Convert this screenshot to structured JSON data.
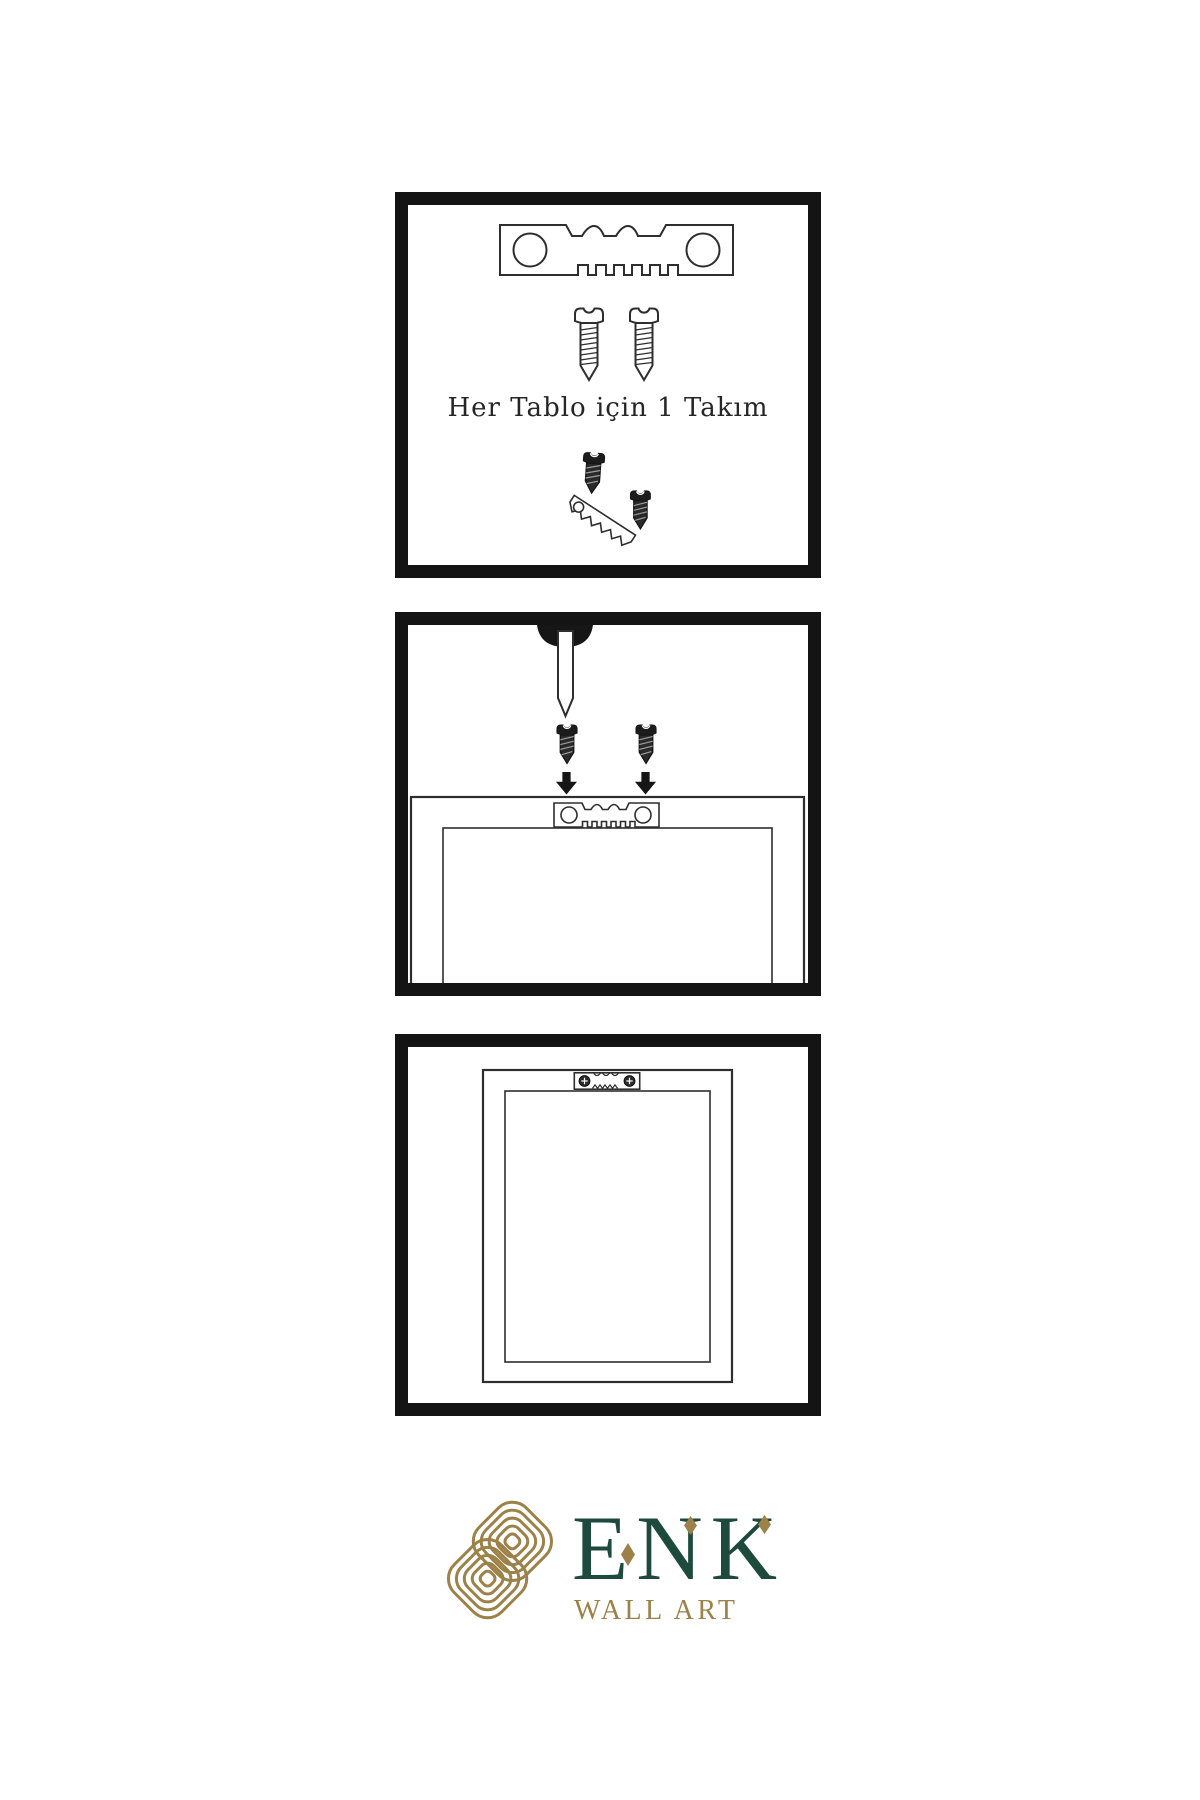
{
  "panels": [
    {
      "name": "hardware-kit-step",
      "caption": "Her Tablo için 1 Takım",
      "icons": [
        "sawtooth-hanger-icon",
        "screw-icon",
        "screw-icon",
        "screw-tilted-icon",
        "sawtooth-hanger-tilted-icon"
      ]
    },
    {
      "name": "install-hanger-step",
      "icons": [
        "wall-nail-icon",
        "screw-icon",
        "screw-icon",
        "down-arrow-icon",
        "down-arrow-icon",
        "sawtooth-hanger-icon",
        "frame-back-outline"
      ]
    },
    {
      "name": "mounted-frame-step",
      "icons": [
        "frame-back-outline",
        "installed-sawtooth-hanger-icon"
      ]
    }
  ],
  "logo": {
    "brand": "ENK",
    "subtitle": "WALL ART",
    "icon": "interlaced-knot-icon"
  },
  "colors": {
    "background": "#ffffff",
    "panel_border": "#141414",
    "line": "#2e2e2e",
    "ink": "#161616",
    "brand_green": "#1d4a3c",
    "brand_gold": "#9c8148"
  }
}
